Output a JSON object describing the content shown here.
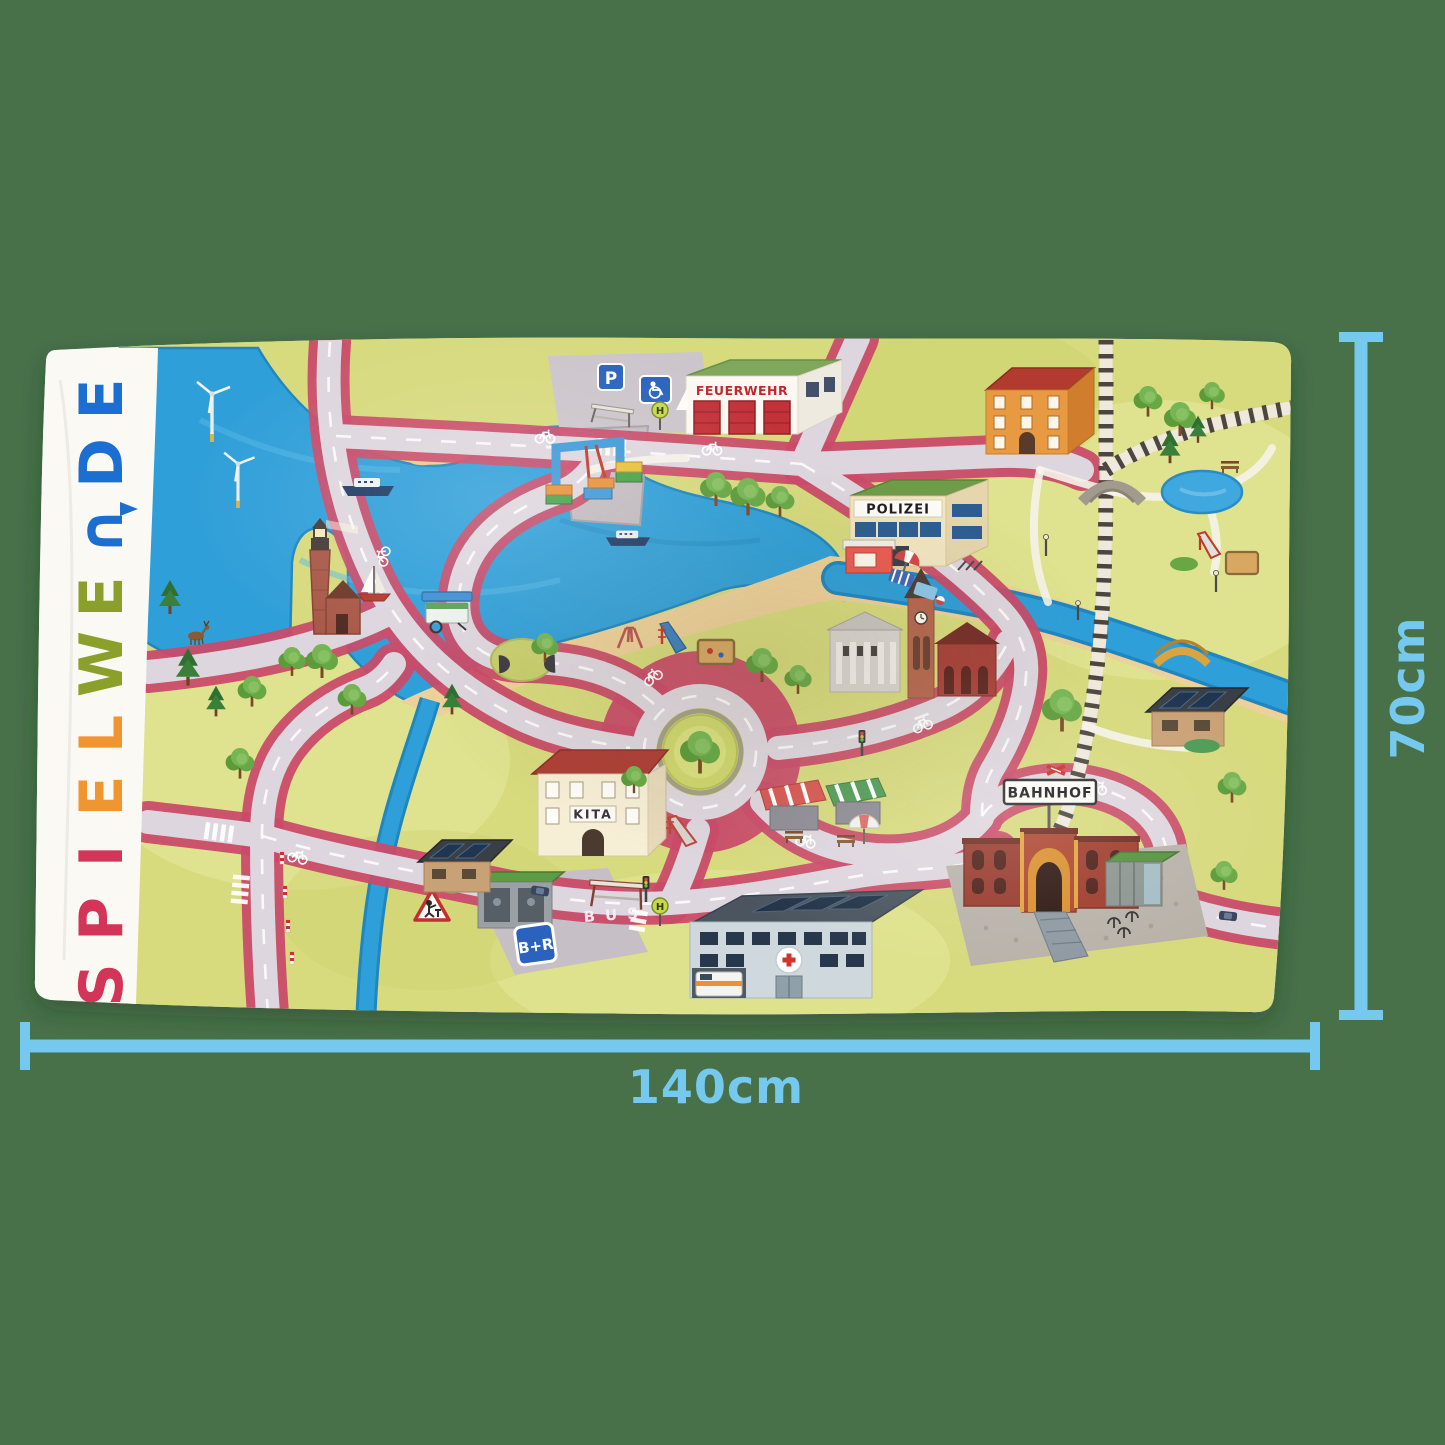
{
  "colors": {
    "background": "#48714a",
    "towel": "#f6f4ee",
    "band": "#fbf9f4",
    "grass": "#d7da7d",
    "water": "#2f9fd9",
    "sand": "#eed09a",
    "road_surface": "#ded6de",
    "bike_lane": "#c94b69",
    "dimension_blue": "#75c8ee"
  },
  "brand": {
    "name": "SPIELWENDE",
    "letters": [
      {
        "char": "S",
        "color": "#d23557"
      },
      {
        "char": "P",
        "color": "#d23557"
      },
      {
        "char": "I",
        "color": "#d23557"
      },
      {
        "char": "E",
        "color": "#f0952f"
      },
      {
        "char": "L",
        "color": "#f0952f"
      },
      {
        "char": "W",
        "color": "#8ba02b"
      },
      {
        "char": "E",
        "color": "#8ba02b"
      },
      {
        "char": "∩",
        "color": "#1b6ed2"
      },
      {
        "char": "D",
        "color": "#1b6ed2"
      },
      {
        "char": "E",
        "color": "#1b6ed2"
      }
    ]
  },
  "dimensions": {
    "width_label": "140cm",
    "height_label": "70cm",
    "line_color": "#75c8ee"
  },
  "map_labels": {
    "fire_station": "FEUERWEHR",
    "police": "POLIZEI",
    "train_station": "BAHNHOF",
    "kindergarten": "KITA",
    "bus_road_marking": "BUS",
    "bike_and_ride_sign": "B+R",
    "bus_stop_sign": "H",
    "parking_sign": "P"
  }
}
